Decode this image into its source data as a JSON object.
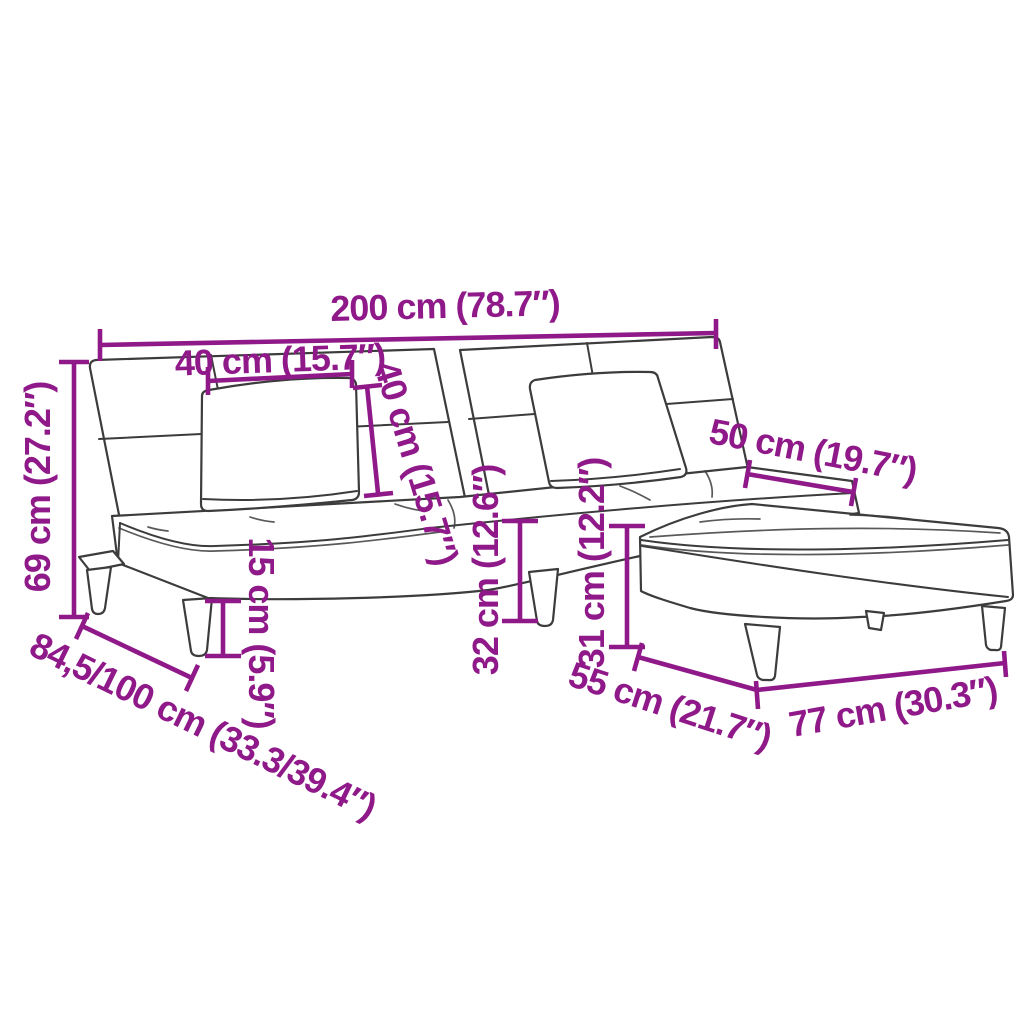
{
  "diagram": {
    "title": "sofa-bed-with-footstool-dimension-diagram",
    "accent_color": "#8F1989",
    "line_color": "#3c3c3c",
    "background_color": "#ffffff",
    "dimensions": [
      {
        "id": "overall-width",
        "label": "200 cm (78.7″)"
      },
      {
        "id": "pillow-width",
        "label": "40 cm (15.7″)"
      },
      {
        "id": "pillow-height",
        "label": "40 cm (15.7″)"
      },
      {
        "id": "backrest-height",
        "label": "69 cm (27.2″)"
      },
      {
        "id": "seat-depth",
        "label": "50 cm (19.7″)"
      },
      {
        "id": "leg-height",
        "label": "15 cm (5.9″)"
      },
      {
        "id": "seat-height",
        "label": "32 cm (12.6″)"
      },
      {
        "id": "footstool-height",
        "label": "31 cm (12.2″)"
      },
      {
        "id": "depth-range",
        "label": "84,5/100 cm (33.3/39.4″)"
      },
      {
        "id": "footstool-depth",
        "label": "55 cm (21.7″)"
      },
      {
        "id": "footstool-width",
        "label": "77 cm (30.3″)"
      }
    ]
  }
}
